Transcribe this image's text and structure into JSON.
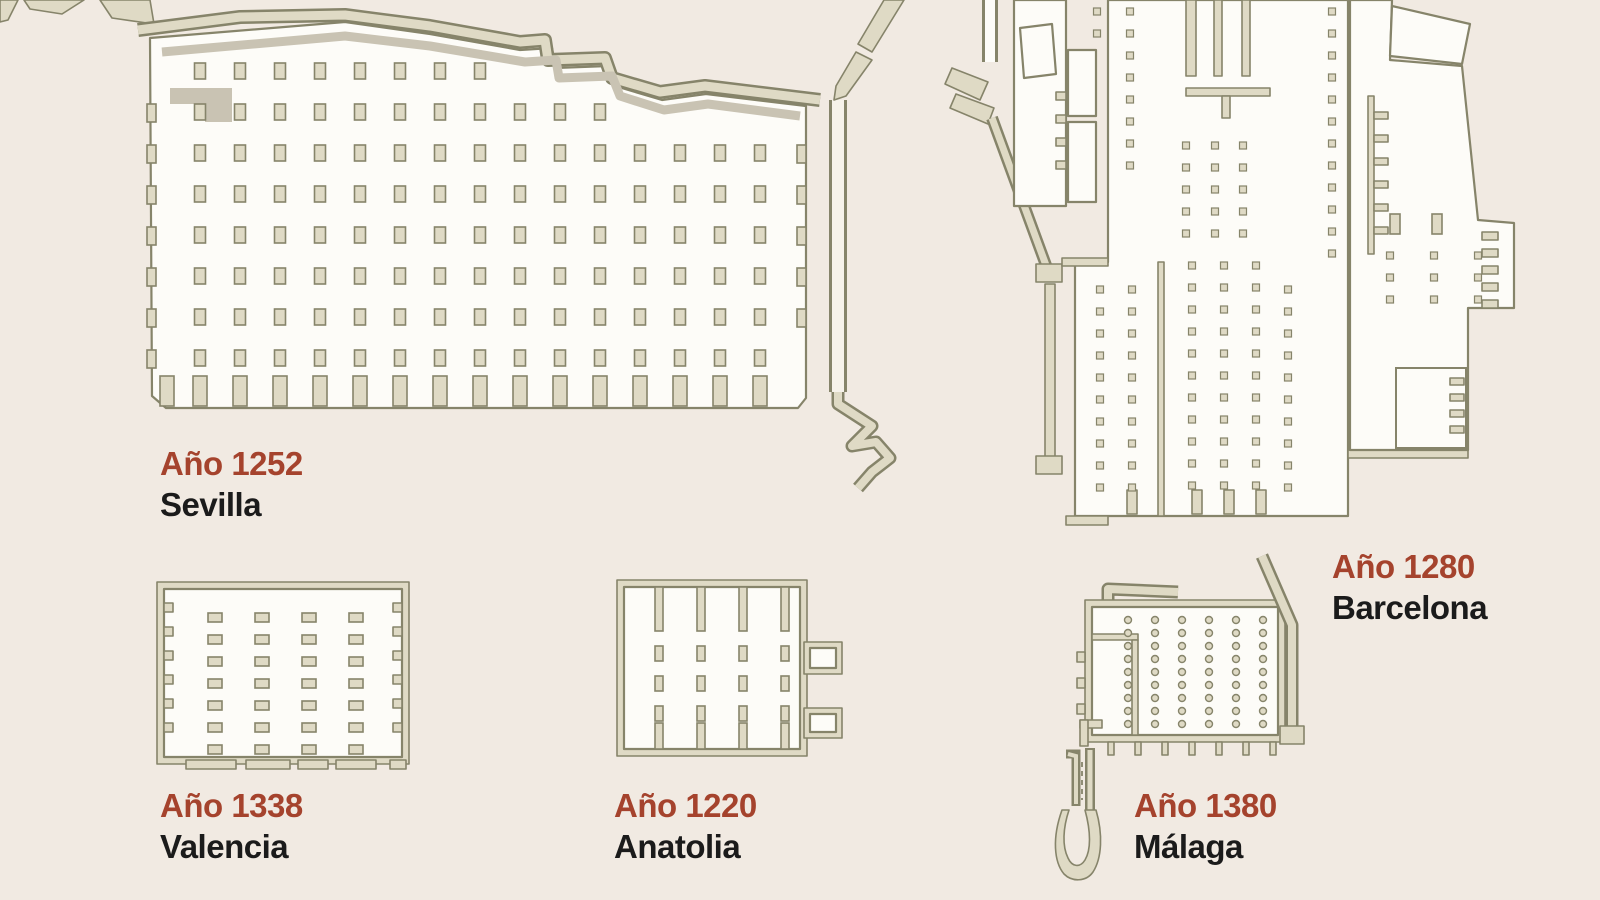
{
  "colors": {
    "background": "#F1EAE2",
    "wall_fill": "#DFDAC5",
    "wall_stroke": "#86846A",
    "interior": "#FDFCF8",
    "shadow_band": "#C9C3B3",
    "year_text": "#A5432D",
    "city_text": "#1B1B1B"
  },
  "plans": [
    {
      "id": "sevilla",
      "year_label": "Año 1252",
      "city": "Sevilla"
    },
    {
      "id": "barcelona",
      "year_label": "Año 1280",
      "city": "Barcelona"
    },
    {
      "id": "valencia",
      "year_label": "Año 1338",
      "city": "Valencia"
    },
    {
      "id": "anatolia",
      "year_label": "Año 1220",
      "city": "Anatolia"
    },
    {
      "id": "malaga",
      "year_label": "Año 1380",
      "city": "Málaga"
    }
  ]
}
